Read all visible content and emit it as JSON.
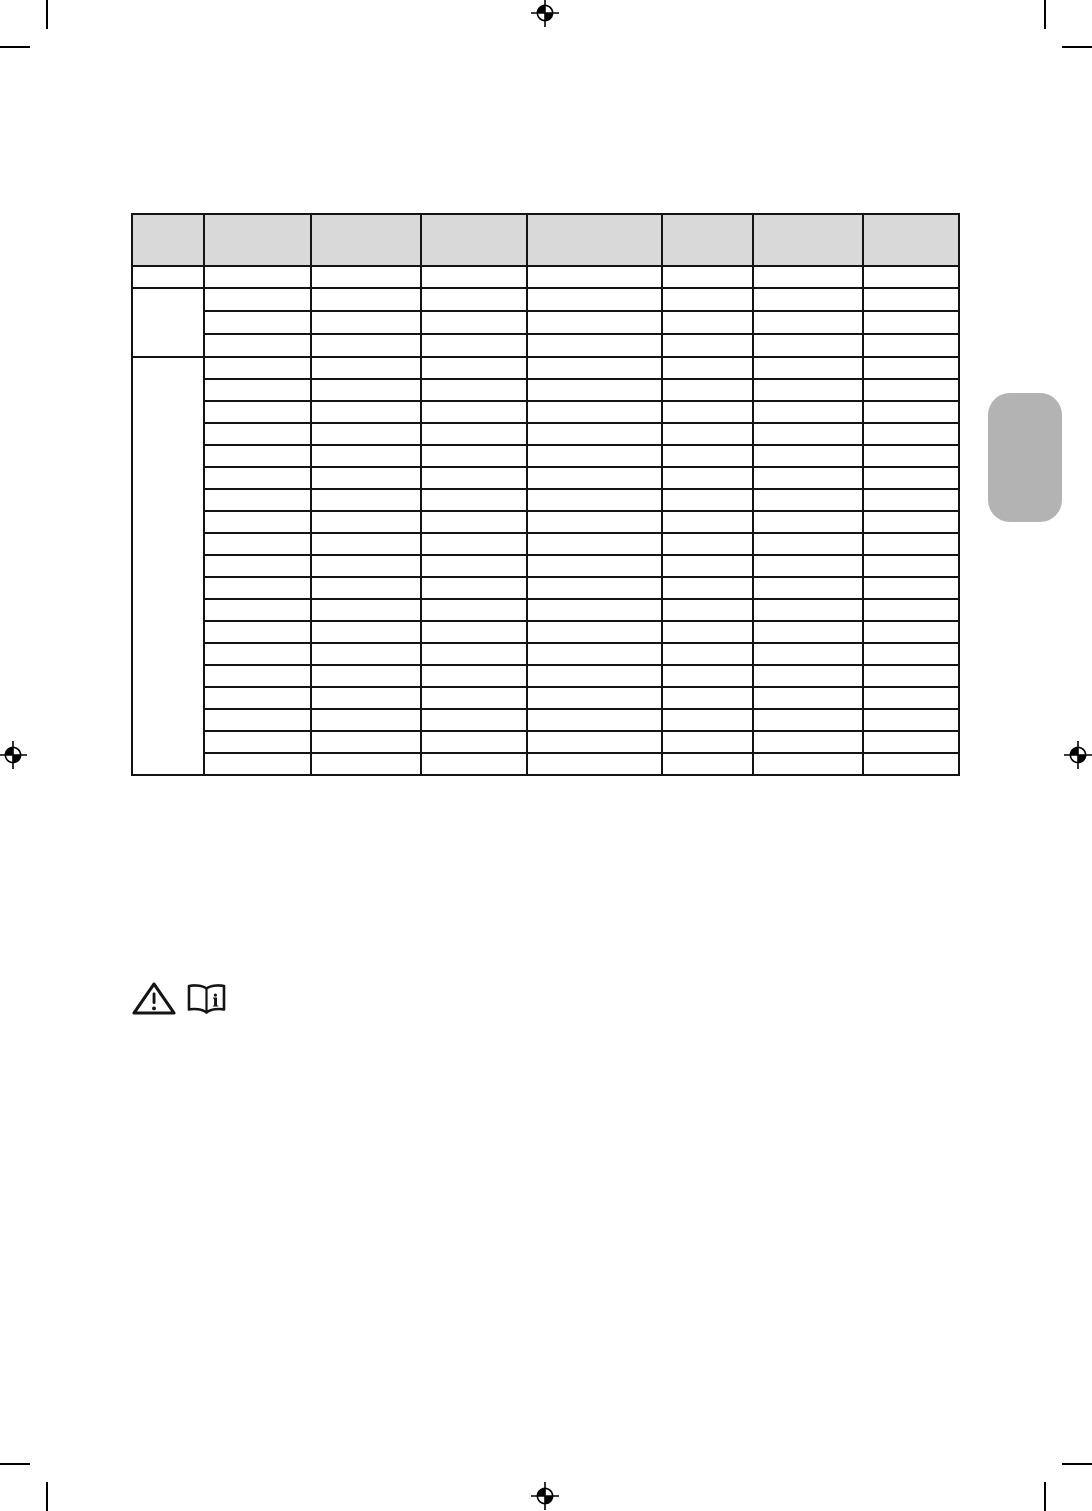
{
  "page": {
    "background_color": "#ffffff",
    "ink_color": "#141414"
  },
  "table": {
    "border_color": "#141414",
    "header_fill_color": "#d9d9d9",
    "header_height_px": 50,
    "columns": [
      {
        "label": "",
        "width_px": 72
      },
      {
        "label": "",
        "width_px": 107
      },
      {
        "label": "",
        "width_px": 110
      },
      {
        "label": "",
        "width_px": 106
      },
      {
        "label": "",
        "width_px": 135
      },
      {
        "label": "",
        "width_px": 91
      },
      {
        "label": "",
        "width_px": 110
      },
      {
        "label": "",
        "width_px": 96
      }
    ],
    "row_groups": [
      {
        "rows": 1,
        "row_class": "row-a",
        "merged_first_column": false,
        "first_column_label": "",
        "cell_text": ""
      },
      {
        "rows": 3,
        "row_class": "row-g1",
        "merged_first_column": true,
        "first_column_label": "",
        "cell_text": ""
      },
      {
        "rows": 19,
        "row_class": "row-g2",
        "merged_first_column": true,
        "first_column_label": "",
        "cell_text": ""
      }
    ]
  },
  "side_tab": {
    "fill_color": "#b3b3b3"
  },
  "safety_symbols": [
    {
      "icon": "warning-triangle-icon"
    },
    {
      "icon": "instruction-manual-icon"
    }
  ],
  "print_marks": {
    "color": "#000000",
    "registration_targets": [
      {
        "position": "top-center"
      },
      {
        "position": "left-middle"
      },
      {
        "position": "right-middle"
      },
      {
        "position": "bottom-center"
      }
    ],
    "corner_crop_marks": [
      "top-left",
      "top-right",
      "bottom-left",
      "bottom-right"
    ]
  }
}
